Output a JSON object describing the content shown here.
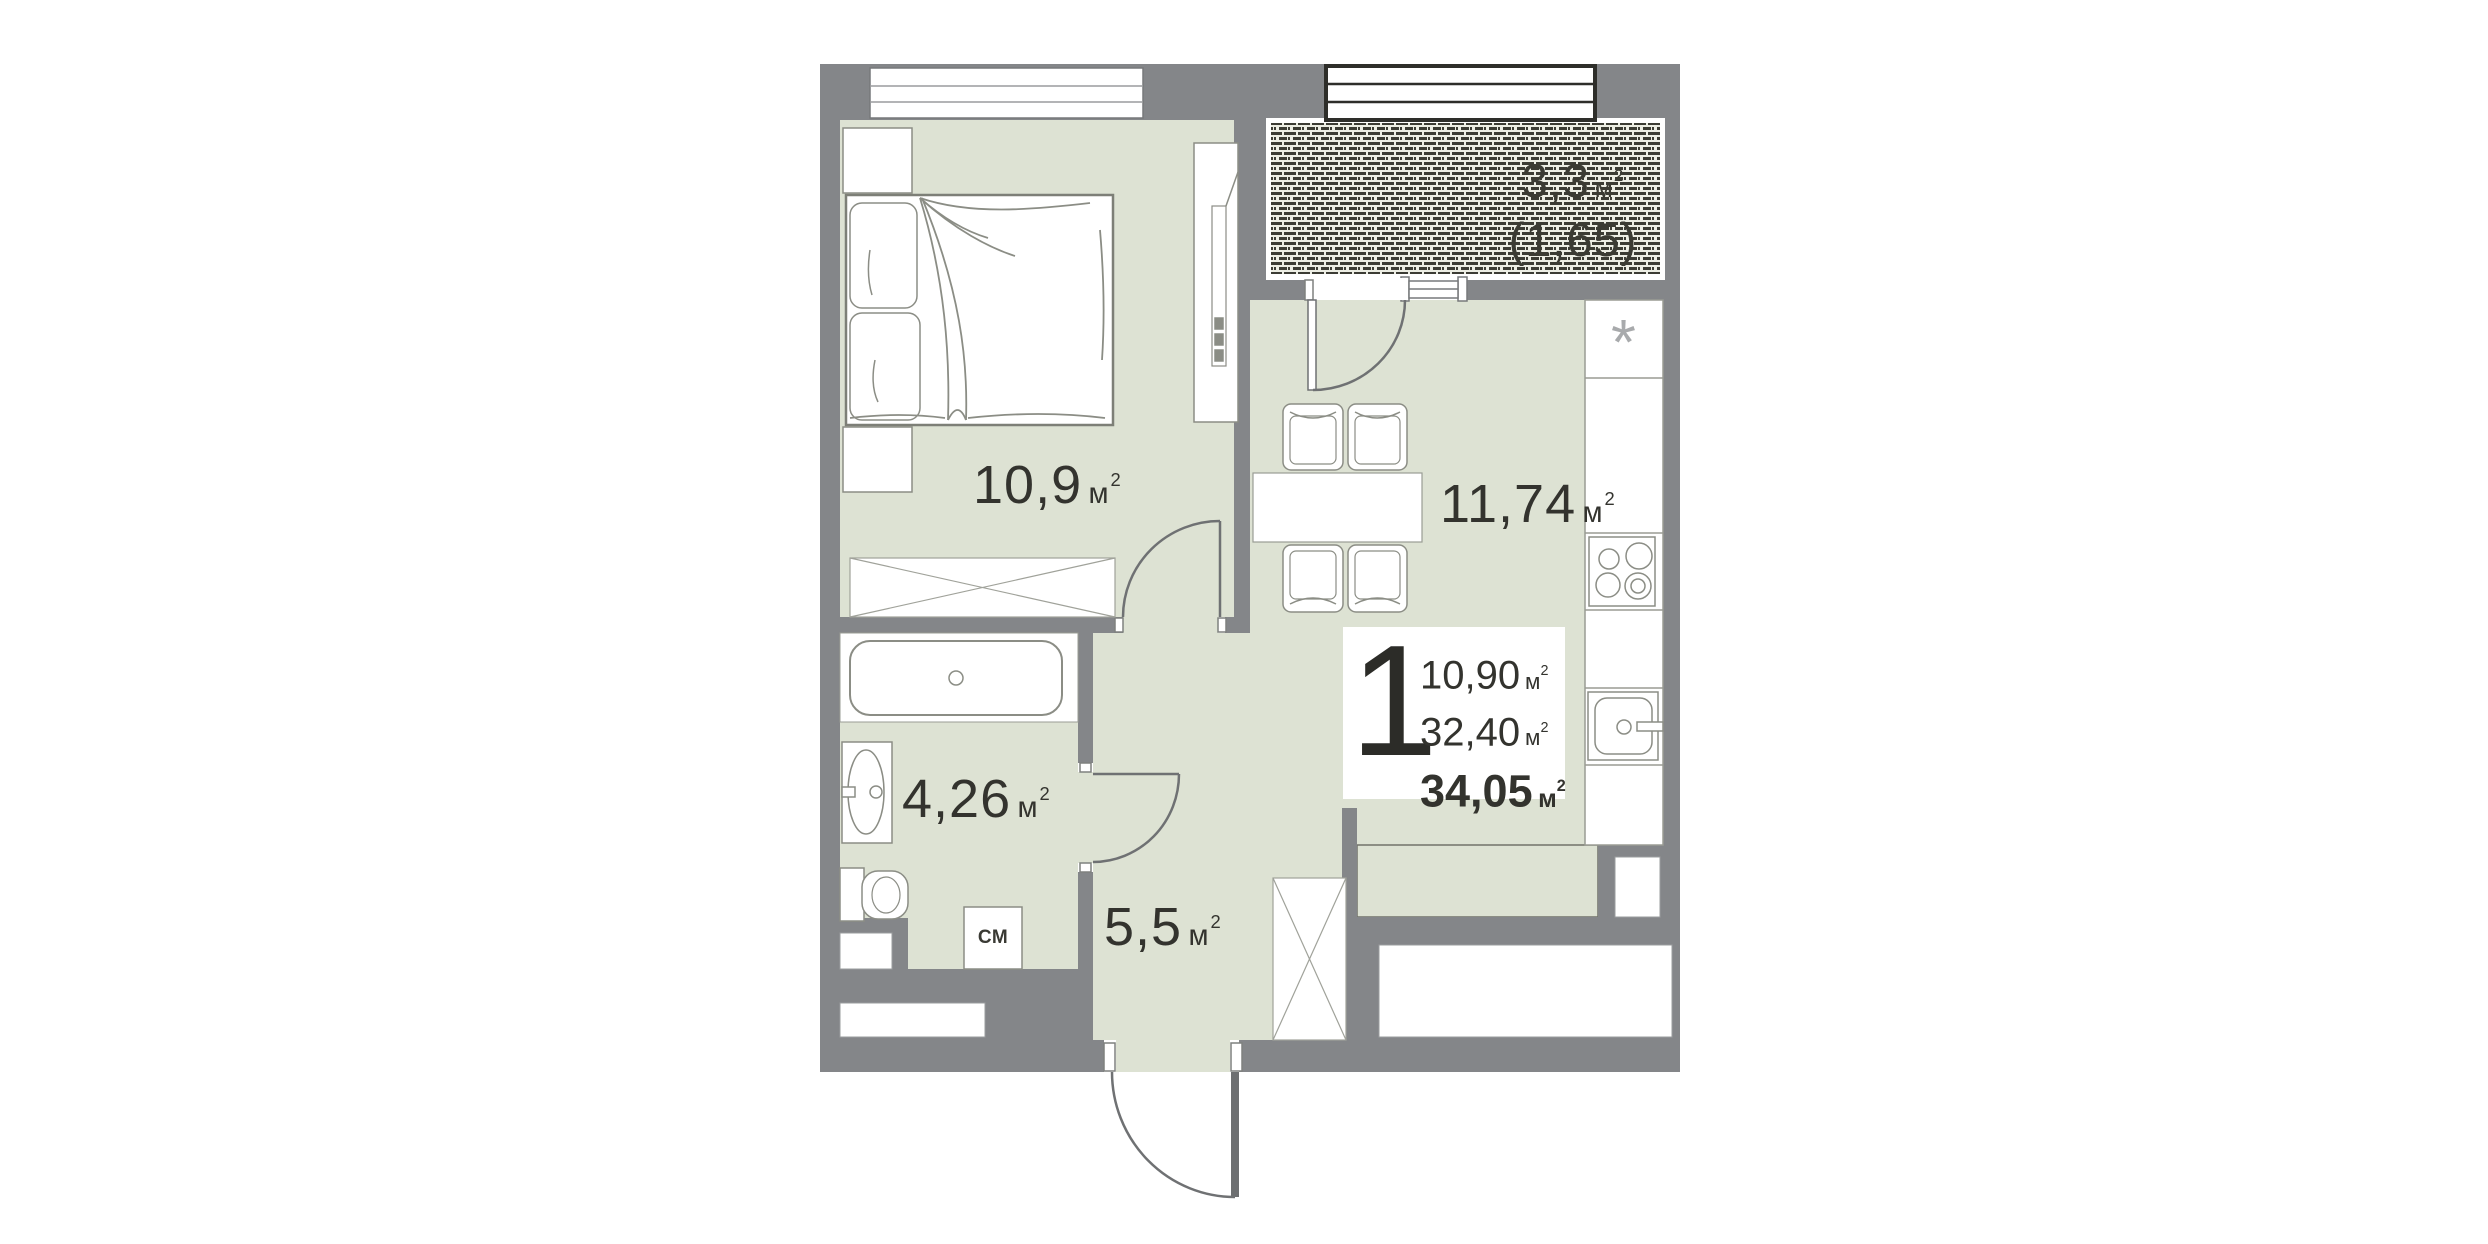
{
  "floorplan": {
    "unit_number": "1",
    "unit_symbol": "м",
    "unit_exponent": "2",
    "summary": {
      "living_area": "10,90",
      "apartment_area": "32,40",
      "total_area": "34,05"
    },
    "rooms": [
      {
        "id": "bedroom",
        "area": "10,9"
      },
      {
        "id": "kitchen-living",
        "area": "11,74"
      },
      {
        "id": "bathroom",
        "area": "4,26"
      },
      {
        "id": "hallway",
        "area": "5,5"
      },
      {
        "id": "balcony",
        "area": "3,3",
        "coefficient": "(1,65)"
      }
    ],
    "markers": {
      "washing_machine": "СМ",
      "fridge": "*"
    },
    "colors": {
      "wall": "#848689",
      "floor": "#dde2d3",
      "balcony_hatch_bg": "#edeee4",
      "balcony_hatch_dash": "#3c3c34",
      "label_text": "#33332e",
      "fixture_outline": "#8b8d85"
    }
  }
}
